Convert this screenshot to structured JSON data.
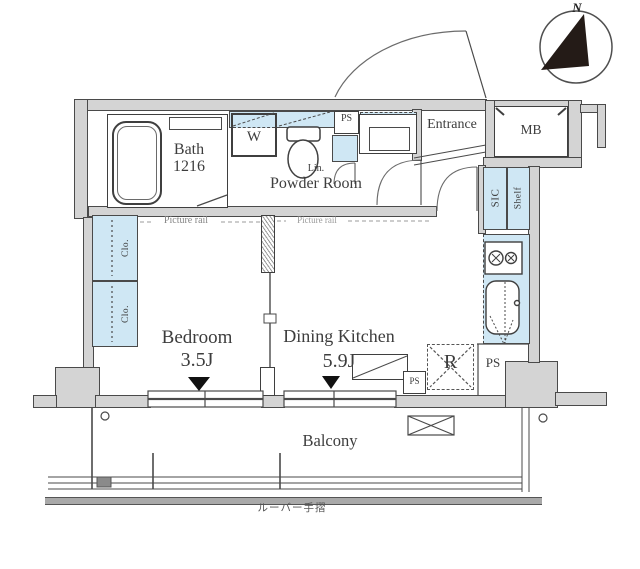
{
  "page": {
    "type": "apartment-floor-plan"
  },
  "colors": {
    "wall_fill": "#d4d4d4",
    "fixture_blue": "#cfe7f4",
    "line": "#4a4a4a",
    "text": "#3d3d3d",
    "muted_text": "#8a8a8a",
    "compass_needle": "#241b17"
  },
  "compass": {
    "north": "N"
  },
  "rooms": {
    "bath": {
      "name": "Bath",
      "size": "1216"
    },
    "powder_room": {
      "name": "Powder Room"
    },
    "entrance": {
      "name": "Entrance"
    },
    "meter_box": {
      "abbr": "MB"
    },
    "shoe_in_closet": {
      "abbr": "SIC",
      "shelf": "Shelf"
    },
    "bedroom": {
      "name": "Bedroom",
      "size": "3.5J",
      "picture_rail": "Picture rail"
    },
    "dining_kitchen": {
      "name": "Dining Kitchen",
      "size": "5.9J",
      "picture_rail": "Picture rail"
    },
    "balcony": {
      "name": "Balcony",
      "handrail_note": "ルーバー手摺"
    }
  },
  "fixtures": {
    "washer": "W",
    "linen": "Lin.",
    "pipe_space_top": "PS",
    "pipe_space_mid": "PS",
    "pipe_space_right": "PS",
    "refrigerator": "R",
    "closet_upper": "Clo.",
    "closet_lower": "Clo."
  }
}
